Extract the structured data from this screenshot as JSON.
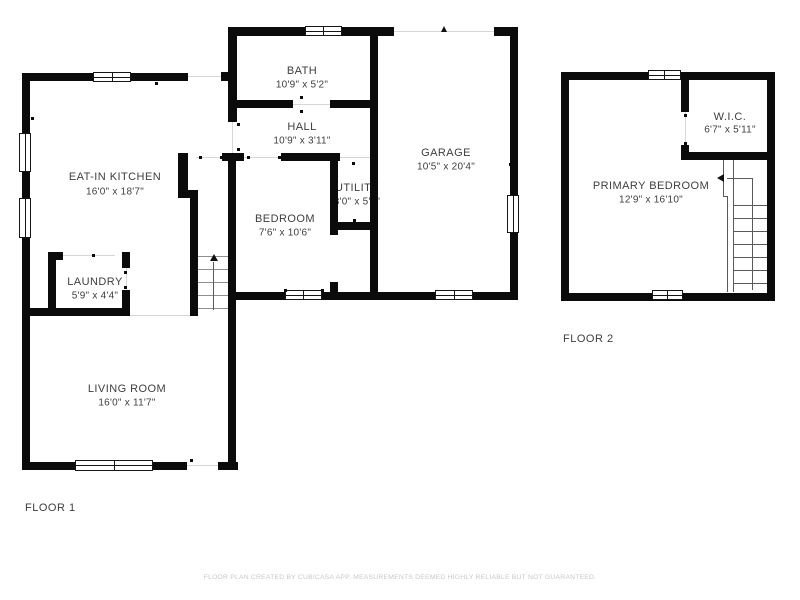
{
  "floors": [
    {
      "label": "FLOOR 1",
      "rooms": [
        {
          "name": "EAT-IN KITCHEN",
          "dimensions": "16'0\" x 18'7\""
        },
        {
          "name": "BATH",
          "dimensions": "10'9\" x 5'2\""
        },
        {
          "name": "HALL",
          "dimensions": "10'9\" x 3'11\""
        },
        {
          "name": "GARAGE",
          "dimensions": "10'5\" x 20'4\""
        },
        {
          "name": "BEDROOM",
          "dimensions": "7'6\" x 10'6\""
        },
        {
          "name": "UTILITY",
          "dimensions": "3'0\" x 5'0\""
        },
        {
          "name": "LAUNDRY",
          "dimensions": "5'9\" x 4'4\""
        },
        {
          "name": "LIVING ROOM",
          "dimensions": "16'0\" x 11'7\""
        }
      ]
    },
    {
      "label": "FLOOR 2",
      "rooms": [
        {
          "name": "PRIMARY BEDROOM",
          "dimensions": "12'9\" x 16'10\""
        },
        {
          "name": "W.I.C.",
          "dimensions": "6'7\" x 5'11\""
        }
      ]
    }
  ],
  "footer": {
    "disclaimer": "FLOOR PLAN CREATED BY CUBICASA APP. MEASUREMENTS DEEMED HIGHLY RELIABLE BUT NOT GUARANTEED."
  },
  "colors": {
    "wall": "#0b0b0b",
    "text": "#3e3e3e",
    "muted": "#c8c8c8",
    "background": "#ffffff"
  }
}
